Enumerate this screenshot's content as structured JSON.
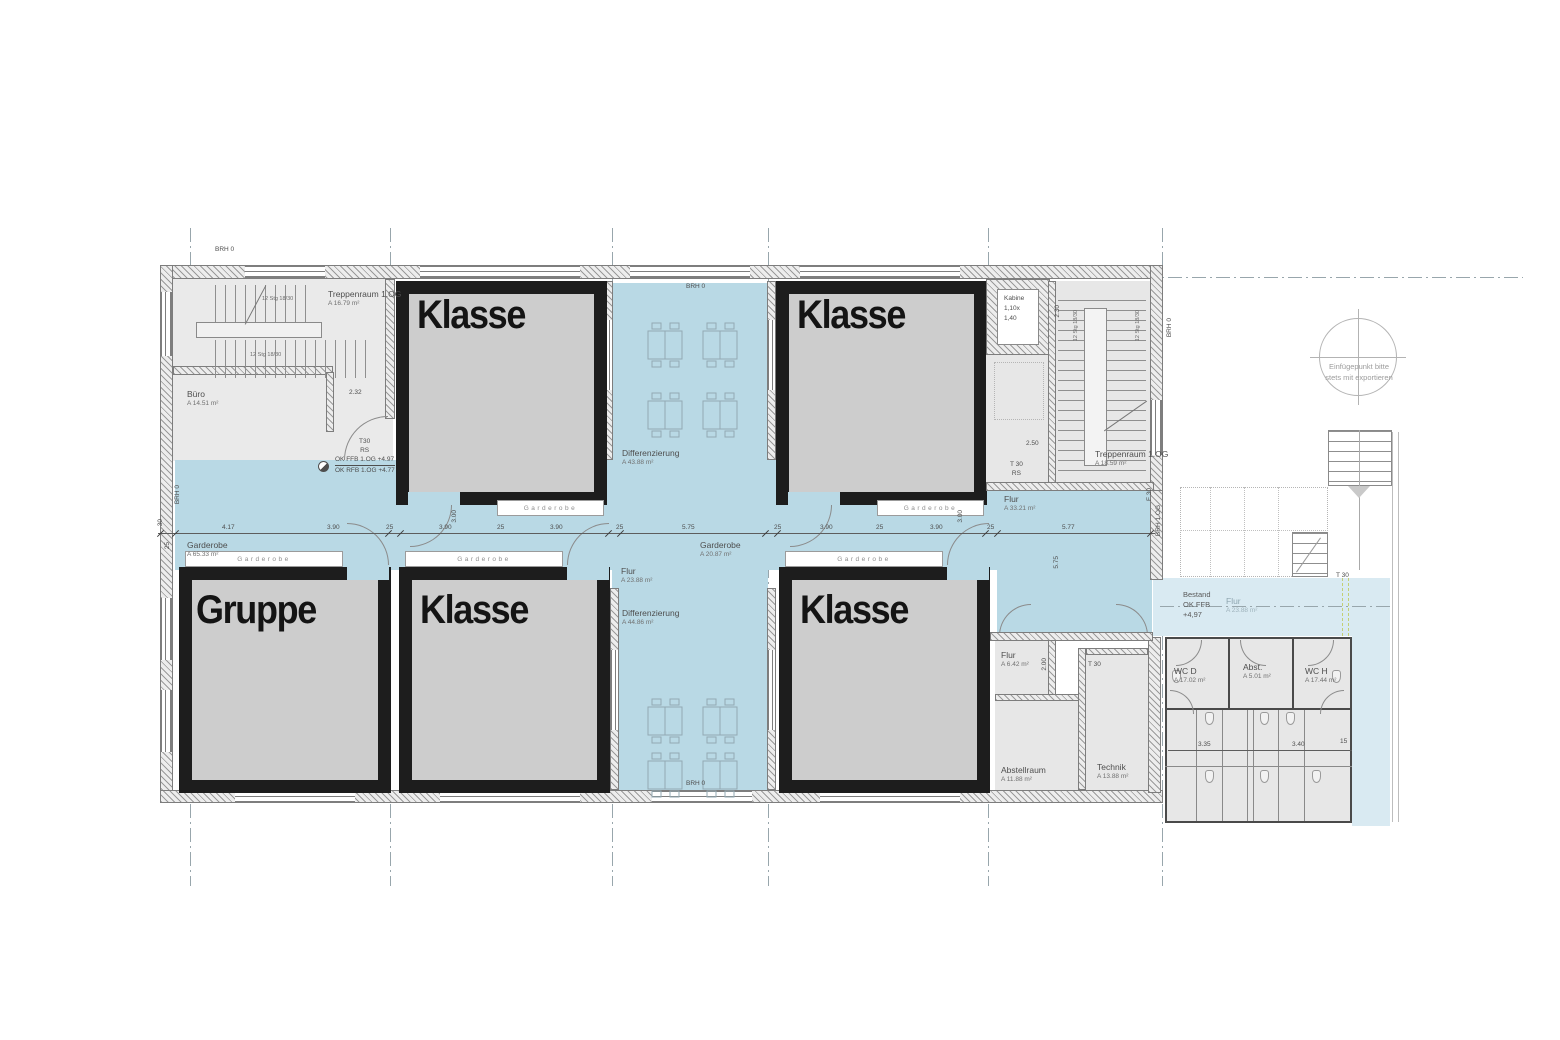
{
  "palette": {
    "blue": "#b9d9e5",
    "blue_light": "#d9eaf2",
    "room_fill": "#cdcdcd",
    "wall_black": "#1d1d1d"
  },
  "big_rooms": {
    "k_tl": "Klasse",
    "k_tr": "Klasse",
    "gruppe": "Gruppe",
    "k_bm": "Klasse",
    "k_br": "Klasse"
  },
  "strip_label": "Garderobe",
  "rooms": {
    "treppenraum_tl": {
      "name": "Treppenraum 1.OG",
      "area": "A 16.79 m²"
    },
    "buero": {
      "name": "Büro",
      "area": "A 14.51 m²"
    },
    "garderobe_main": {
      "name": "Garderobe",
      "area": "A 65.33 m²"
    },
    "garderobe_mid": {
      "name": "Garderobe",
      "area": "A 20.87 m²"
    },
    "diff_top": {
      "name": "Differenzierung",
      "area": "A 43.88 m²"
    },
    "flur_center": {
      "name": "Flur",
      "area": "A 23.88 m²"
    },
    "diff_bottom": {
      "name": "Differenzierung",
      "area": "A 44.86 m²"
    },
    "flur_right": {
      "name": "Flur",
      "area": "A 33.21 m²"
    },
    "treppenraum_tr": {
      "name": "Treppenraum 1.OG",
      "area": "A 18.59 m²"
    },
    "flur_small": {
      "name": "Flur",
      "area": "A 6.42 m²"
    },
    "abstellraum": {
      "name": "Abstellraum",
      "area": "A 11.88 m²"
    },
    "technik": {
      "name": "Technik",
      "area": "A 13.88 m²"
    },
    "flur_bestand": {
      "name": "Flur",
      "area": "A 23.88 m²"
    },
    "wc_d": {
      "name": "WC D",
      "area": "A 17.02 m²"
    },
    "abst": {
      "name": "Abst.",
      "area": "A 5.01 m²"
    },
    "wc_h": {
      "name": "WC H",
      "area": "A 17.44 m²"
    }
  },
  "annotations": {
    "brh0": "BRH 0",
    "brh1og": "BRH 1.OG",
    "f30": "F 30",
    "t30": "T 30",
    "t30_l1": "T30",
    "t30_l2": "RS",
    "t30r_l1": "T 30",
    "t30r_l2": "RS",
    "kabine_l1": "Kabine",
    "kabine_l2": "1,10x",
    "kabine_l3": "1,40",
    "stair_note": "12 Stg 18/30",
    "level_ffb": "OK FFB 1.OG +4.97",
    "level_rfb": "OK RFB 1.OG +4.77",
    "bestand_l1": "Bestand",
    "bestand_l2": "OK FFB",
    "bestand_l3": "+4,97",
    "einfuege_l1": "Einfügepunkt bitte",
    "einfuege_l2": "stets mit exportieren"
  },
  "dims": {
    "chain": [
      "30",
      "4.17",
      "3.90",
      "25",
      "3.90",
      "25",
      "3.90",
      "25",
      "5.75",
      "25",
      "3.90",
      "25",
      "3.90",
      "25",
      "5.77"
    ],
    "v300a": "3.00",
    "v300b": "3.00",
    "v575": "5.75",
    "d232": "2.32",
    "d250": "2.50",
    "v200": "2.00",
    "d335": "3.35",
    "d340": "3.40",
    "d15": "15",
    "v25": "25",
    "v30": "30",
    "v230": "2.30"
  }
}
